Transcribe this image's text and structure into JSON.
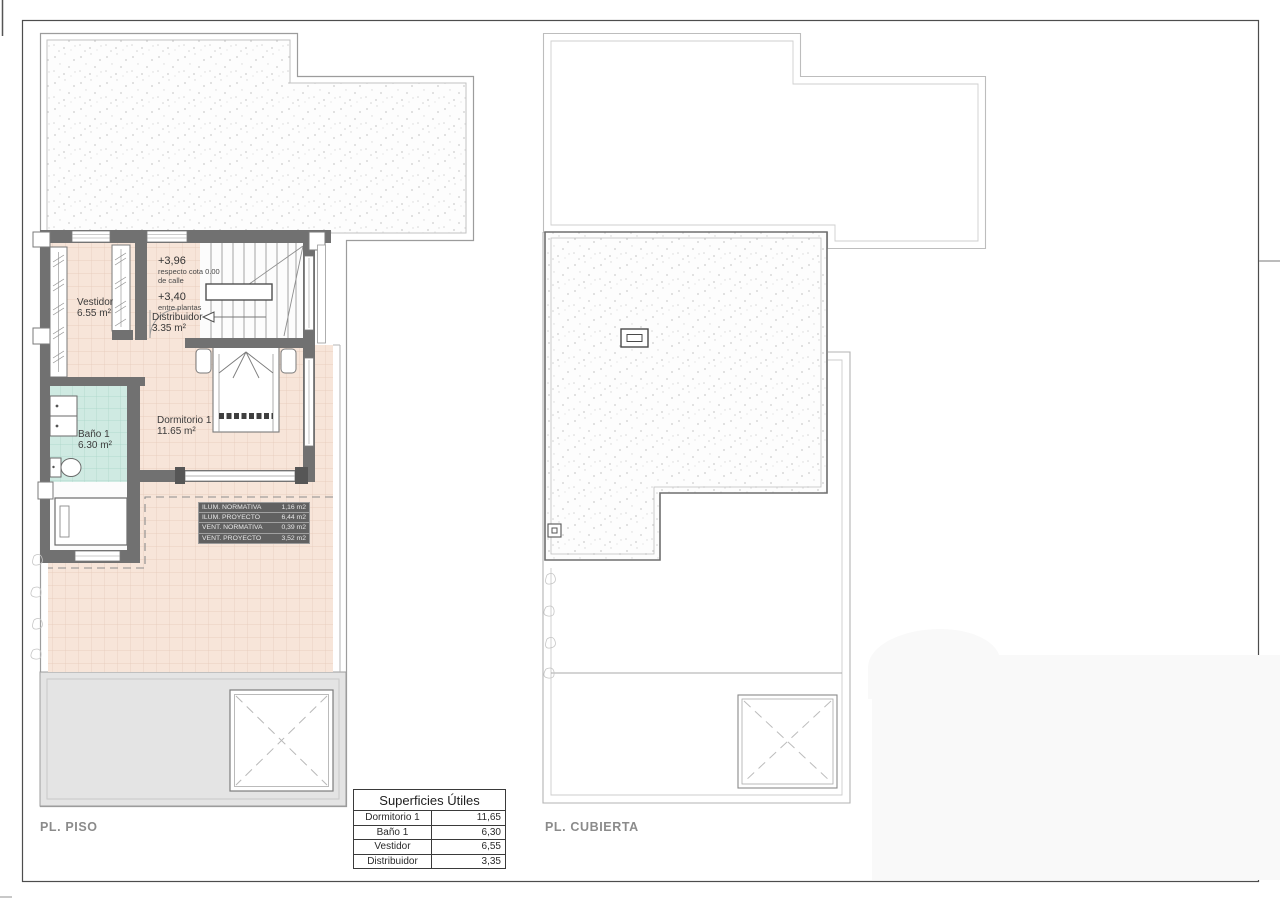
{
  "titles": {
    "left": "PL. PISO",
    "right": "PL. CUBIERTA"
  },
  "rooms": {
    "vestidor": {
      "name": "Vestidor",
      "area": "6.55 m²"
    },
    "bano": {
      "name": "Baño 1",
      "area": "6.30 m²"
    },
    "dormitorio": {
      "name": "Dormitorio 1",
      "area": "11.65 m²"
    },
    "distribuidor": {
      "name": "Distribuidor",
      "area": "3.35 m²"
    }
  },
  "levels": {
    "upper": "+3,96",
    "upper_note1": "respecto cota 0.00",
    "upper_note2": "de calle",
    "mid": "+3,40",
    "mid_note": "entre plantas"
  },
  "ilum_table": {
    "rows": [
      {
        "label": "ILUM. NORMATIVA",
        "value": "1,16 m2"
      },
      {
        "label": "ILUM. PROYECTO",
        "value": "6,44 m2"
      },
      {
        "label": "VENT. NORMATIVA",
        "value": "0,39 m2"
      },
      {
        "label": "VENT. PROYECTO",
        "value": "3,52 m2"
      }
    ]
  },
  "surfaces_table": {
    "title": "Superficies Útiles",
    "rows": [
      {
        "room": "Dormitorio 1",
        "value": "11,65"
      },
      {
        "room": "Baño 1",
        "value": "6,30"
      },
      {
        "room": "Vestidor",
        "value": "6,55"
      },
      {
        "room": "Distribuidor",
        "value": "3,35"
      }
    ]
  },
  "colors": {
    "wall": "#717171",
    "floor_tile": "#f7e5d9",
    "bath_tile": "#cfeae2",
    "terrace_gray": "#e4e4e4",
    "stipple_dot": "#cecece"
  }
}
